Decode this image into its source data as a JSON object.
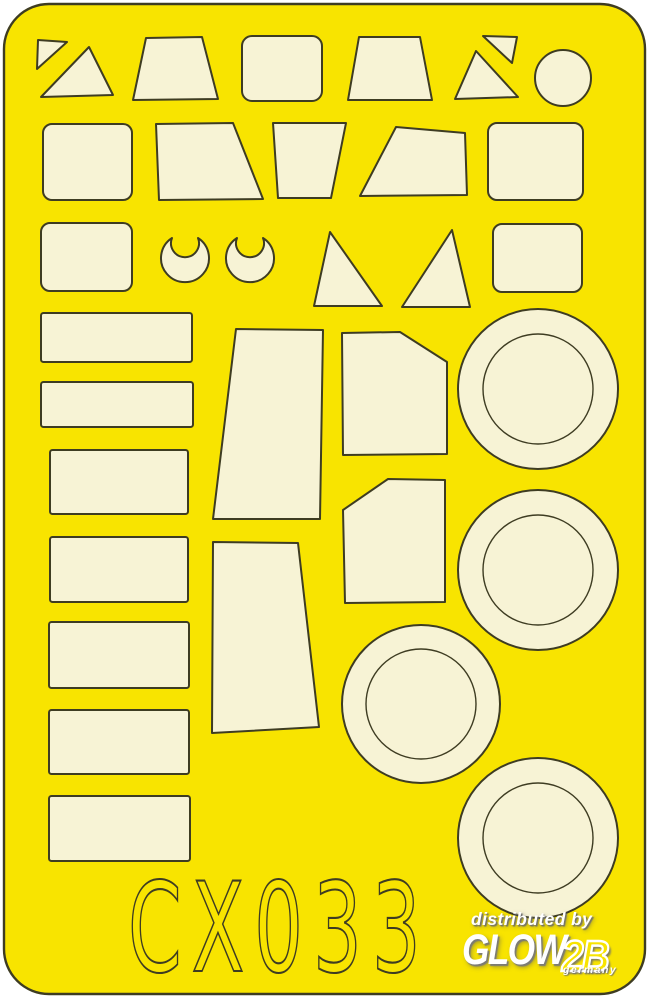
{
  "sheet": {
    "code_text": "CX033",
    "colors": {
      "background": "#ffffff",
      "sheet_yellow": "#f8e400",
      "mask_cream": "#f7f3d5",
      "outline": "#3e3c22",
      "watermark_white": "#ffffff"
    },
    "outline_rect": {
      "x": 4,
      "y": 4,
      "w": 641,
      "h": 990,
      "rx": 45
    }
  },
  "watermark": {
    "line1": "distributed by",
    "brand": "GLOW",
    "brand_suffix": "2B",
    "country": "germany"
  },
  "shapes": {
    "polygons": [
      {
        "name": "mask-triangle-small-tl",
        "points": "38,40 67,42 37,69"
      },
      {
        "name": "mask-triangle-large-tl",
        "points": "89,47 113,95 41,97"
      },
      {
        "name": "mask-trapezoid-row1-a",
        "points": "146,38 202,37 218,99 133,100"
      },
      {
        "name": "mask-trapezoid-row1-b",
        "points": "359,37 420,37 432,100 348,100"
      },
      {
        "name": "mask-triangle-small-tr",
        "points": "483,36 517,37 512,63"
      },
      {
        "name": "mask-triangle-row1-tr",
        "points": "476,51 518,97 455,99"
      },
      {
        "name": "mask-quad-row2-a",
        "points": "156,124 233,123 263,199 159,200"
      },
      {
        "name": "mask-quad-row2-b",
        "points": "273,123 346,123 331,198 278,198"
      },
      {
        "name": "mask-quad-row2-c",
        "points": "396,127 465,133 467,195 360,196"
      },
      {
        "name": "mask-triangle-row3-a",
        "points": "330,232 382,306 314,306"
      },
      {
        "name": "mask-triangle-row3-b",
        "points": "452,230 470,307 402,307"
      },
      {
        "name": "mask-windshield-tall-upper",
        "points": "236,329 323,330 320,519 213,519"
      },
      {
        "name": "mask-windshield-tall-lower",
        "points": "213,542 298,543 319,727 212,733"
      },
      {
        "name": "mask-pentagon-cut-tr",
        "points": "342,333 400,332 447,362 447,454 343,455"
      },
      {
        "name": "mask-pentagon-cut-tl",
        "points": "388,479 445,480 445,602 345,603 343,510"
      }
    ],
    "rounded_rects": [
      {
        "name": "mask-rounded-rect-row1",
        "x": 242,
        "y": 36,
        "w": 80,
        "h": 65,
        "rx": 10
      },
      {
        "name": "mask-rounded-rect-row2-l",
        "x": 43,
        "y": 124,
        "w": 89,
        "h": 76,
        "rx": 9
      },
      {
        "name": "mask-rounded-rect-row2-r",
        "x": 488,
        "y": 123,
        "w": 95,
        "h": 77,
        "rx": 9
      },
      {
        "name": "mask-rounded-rect-row3-l",
        "x": 41,
        "y": 223,
        "w": 91,
        "h": 68,
        "rx": 9
      },
      {
        "name": "mask-rounded-rect-row3-r",
        "x": 493,
        "y": 224,
        "w": 89,
        "h": 68,
        "rx": 9
      }
    ],
    "rects": [
      {
        "name": "mask-strip-1",
        "x": 41,
        "y": 313,
        "w": 151,
        "h": 49
      },
      {
        "name": "mask-strip-2",
        "x": 41,
        "y": 382,
        "w": 152,
        "h": 45
      },
      {
        "name": "mask-strip-3",
        "x": 50,
        "y": 450,
        "w": 138,
        "h": 64
      },
      {
        "name": "mask-strip-4",
        "x": 50,
        "y": 537,
        "w": 138,
        "h": 65
      },
      {
        "name": "mask-strip-5",
        "x": 49,
        "y": 622,
        "w": 140,
        "h": 66
      },
      {
        "name": "mask-strip-6",
        "x": 49,
        "y": 710,
        "w": 140,
        "h": 64
      },
      {
        "name": "mask-strip-7",
        "x": 49,
        "y": 796,
        "w": 141,
        "h": 65
      }
    ],
    "circles": [
      {
        "name": "mask-circle-row1",
        "cx": 563,
        "cy": 78,
        "r": 28
      }
    ],
    "rings": [
      {
        "name": "mask-wheel-ring-1",
        "cx": 538,
        "cy": 389,
        "r_outer": 80,
        "r_inner": 55
      },
      {
        "name": "mask-wheel-ring-2",
        "cx": 538,
        "cy": 570,
        "r_outer": 80,
        "r_inner": 55
      },
      {
        "name": "mask-wheel-ring-3",
        "cx": 421,
        "cy": 704,
        "r_outer": 79,
        "r_inner": 55
      },
      {
        "name": "mask-wheel-ring-4",
        "cx": 538,
        "cy": 838,
        "r_outer": 80,
        "r_inner": 55
      }
    ],
    "crescents": [
      {
        "name": "mask-crescent-1",
        "cx": 185,
        "cy": 258
      },
      {
        "name": "mask-crescent-2",
        "cx": 250,
        "cy": 258
      }
    ],
    "crescent_path": "M -13 -20 A 24 24 0 1 0 13 -20 A 14 14 0 1 1 -13 -20 Z"
  }
}
